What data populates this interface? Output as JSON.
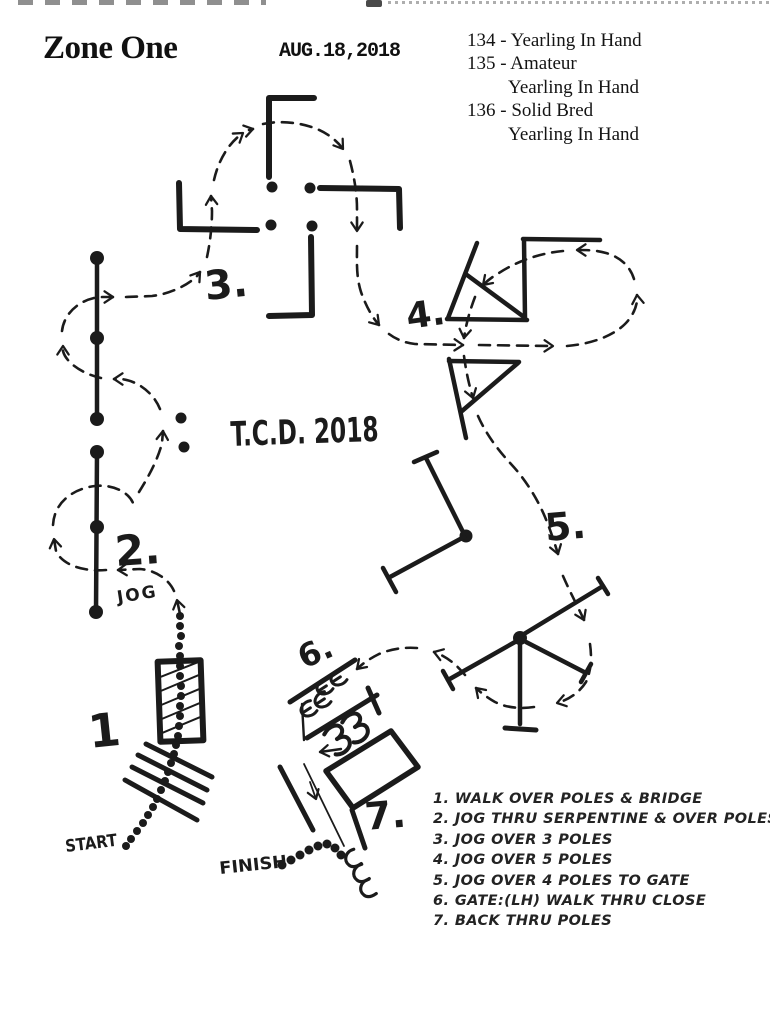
{
  "header": {
    "title": "Zone One",
    "date": "AUG.18,2018",
    "classes": [
      "134 - Yearling In Hand",
      "135 - Amateur",
      "Yearling In Hand",
      "136 - Solid Bred",
      "Yearling In Hand"
    ]
  },
  "course": {
    "center_title": "T.C.D. 2018",
    "labels": {
      "n1": "1",
      "n2": "2.",
      "n3": "3.",
      "n4": "4.",
      "n5": "5.",
      "n6": "6.",
      "n7": "7.",
      "jog": "JOG",
      "start": "START",
      "finish": "FINISH"
    }
  },
  "notes": {
    "items": [
      "1. WALK OVER POLES & BRIDGE",
      "2. JOG THRU SERPENTINE & OVER POLES",
      "3. JOG OVER 3 POLES",
      "4. JOG OVER 5 POLES",
      "5. JOG OVER 4 POLES TO GATE",
      "6. GATE:(LH) WALK THRU CLOSE",
      "7. BACK THRU POLES"
    ]
  },
  "ink_color": "#1b1b1b"
}
